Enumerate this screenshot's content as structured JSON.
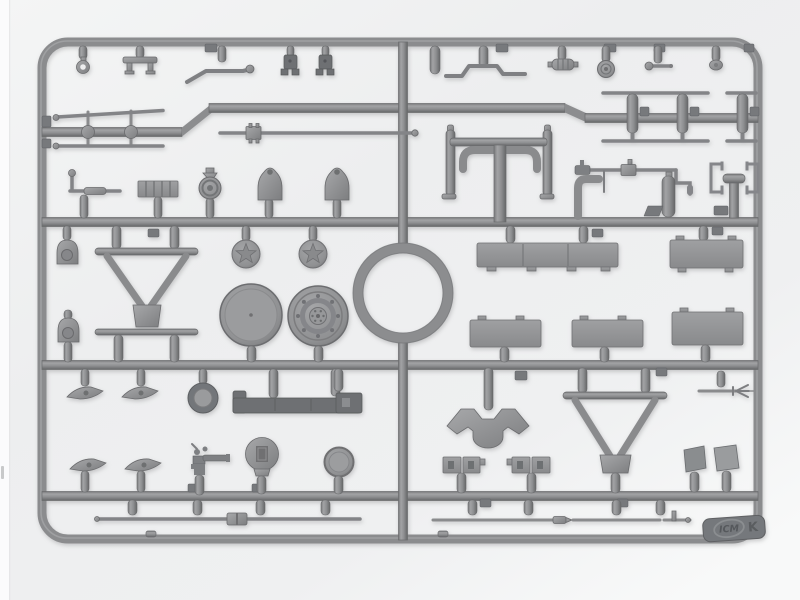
{
  "meta": {
    "description": "Photograph of an injection-moulded plastic model kit sprue (runner frame) letter K by ICM: grey styrene frame with chassis, suspension, wheel, tow-bar, panel and rod parts attached, shot on a light neutral background."
  },
  "sprue": {
    "brand_logo": "ICM",
    "letter": "K"
  },
  "colors": {
    "background": "#eff0f1",
    "plastic_mid": "#8c8d8f",
    "plastic_light": "#a3a4a6",
    "plastic_dark": "#6e7073",
    "tab": "#75787b"
  },
  "parts": [
    "tow-eyelet",
    "u-bracket",
    "bent-rod",
    "hinge-shackle-a",
    "hinge-shackle-b",
    "step-wire",
    "finned-cylinder",
    "hub-cap",
    "knob-rod",
    "oval-cap",
    "sprue-stub",
    "tie-rods-with-ball-joints",
    "barrel-with-collar",
    "torsion-rods",
    "shock-cylinders",
    "crank-lever",
    "ribbed-block",
    "pulley-bracket",
    "bell-bracket-a",
    "bell-bracket-b",
    "spring-hanger-a",
    "spring-hanger-b",
    "manifold-frame",
    "starter-crank-rod",
    "elbow-pipe",
    "reservoir-cylinder",
    "channel-bracket-left",
    "channel-bracket-right",
    "t-bracket",
    "tow-triangle-small",
    "lower-bar",
    "star-wheel-a",
    "star-wheel-b",
    "disc-wheel",
    "bolted-wheel-hub",
    "round-ring",
    "cargo-panel-long",
    "cargo-panel-2",
    "cargo-panel-3",
    "cargo-panel-4",
    "cargo-panel-5",
    "wing-blade-1",
    "wing-blade-2",
    "wing-blade-3",
    "wing-blade-4",
    "roller-drum",
    "bumper-beam",
    "axle-y-bracket",
    "tow-triangle-large",
    "fork-rod",
    "pump-part",
    "slotted-lamp",
    "small-disc",
    "slotted-block-a",
    "slotted-block-b",
    "angled-panel-a",
    "angled-panel-b",
    "barrel-rod-long",
    "rod-with-tip",
    "rod-with-pin",
    "icm-tab"
  ]
}
